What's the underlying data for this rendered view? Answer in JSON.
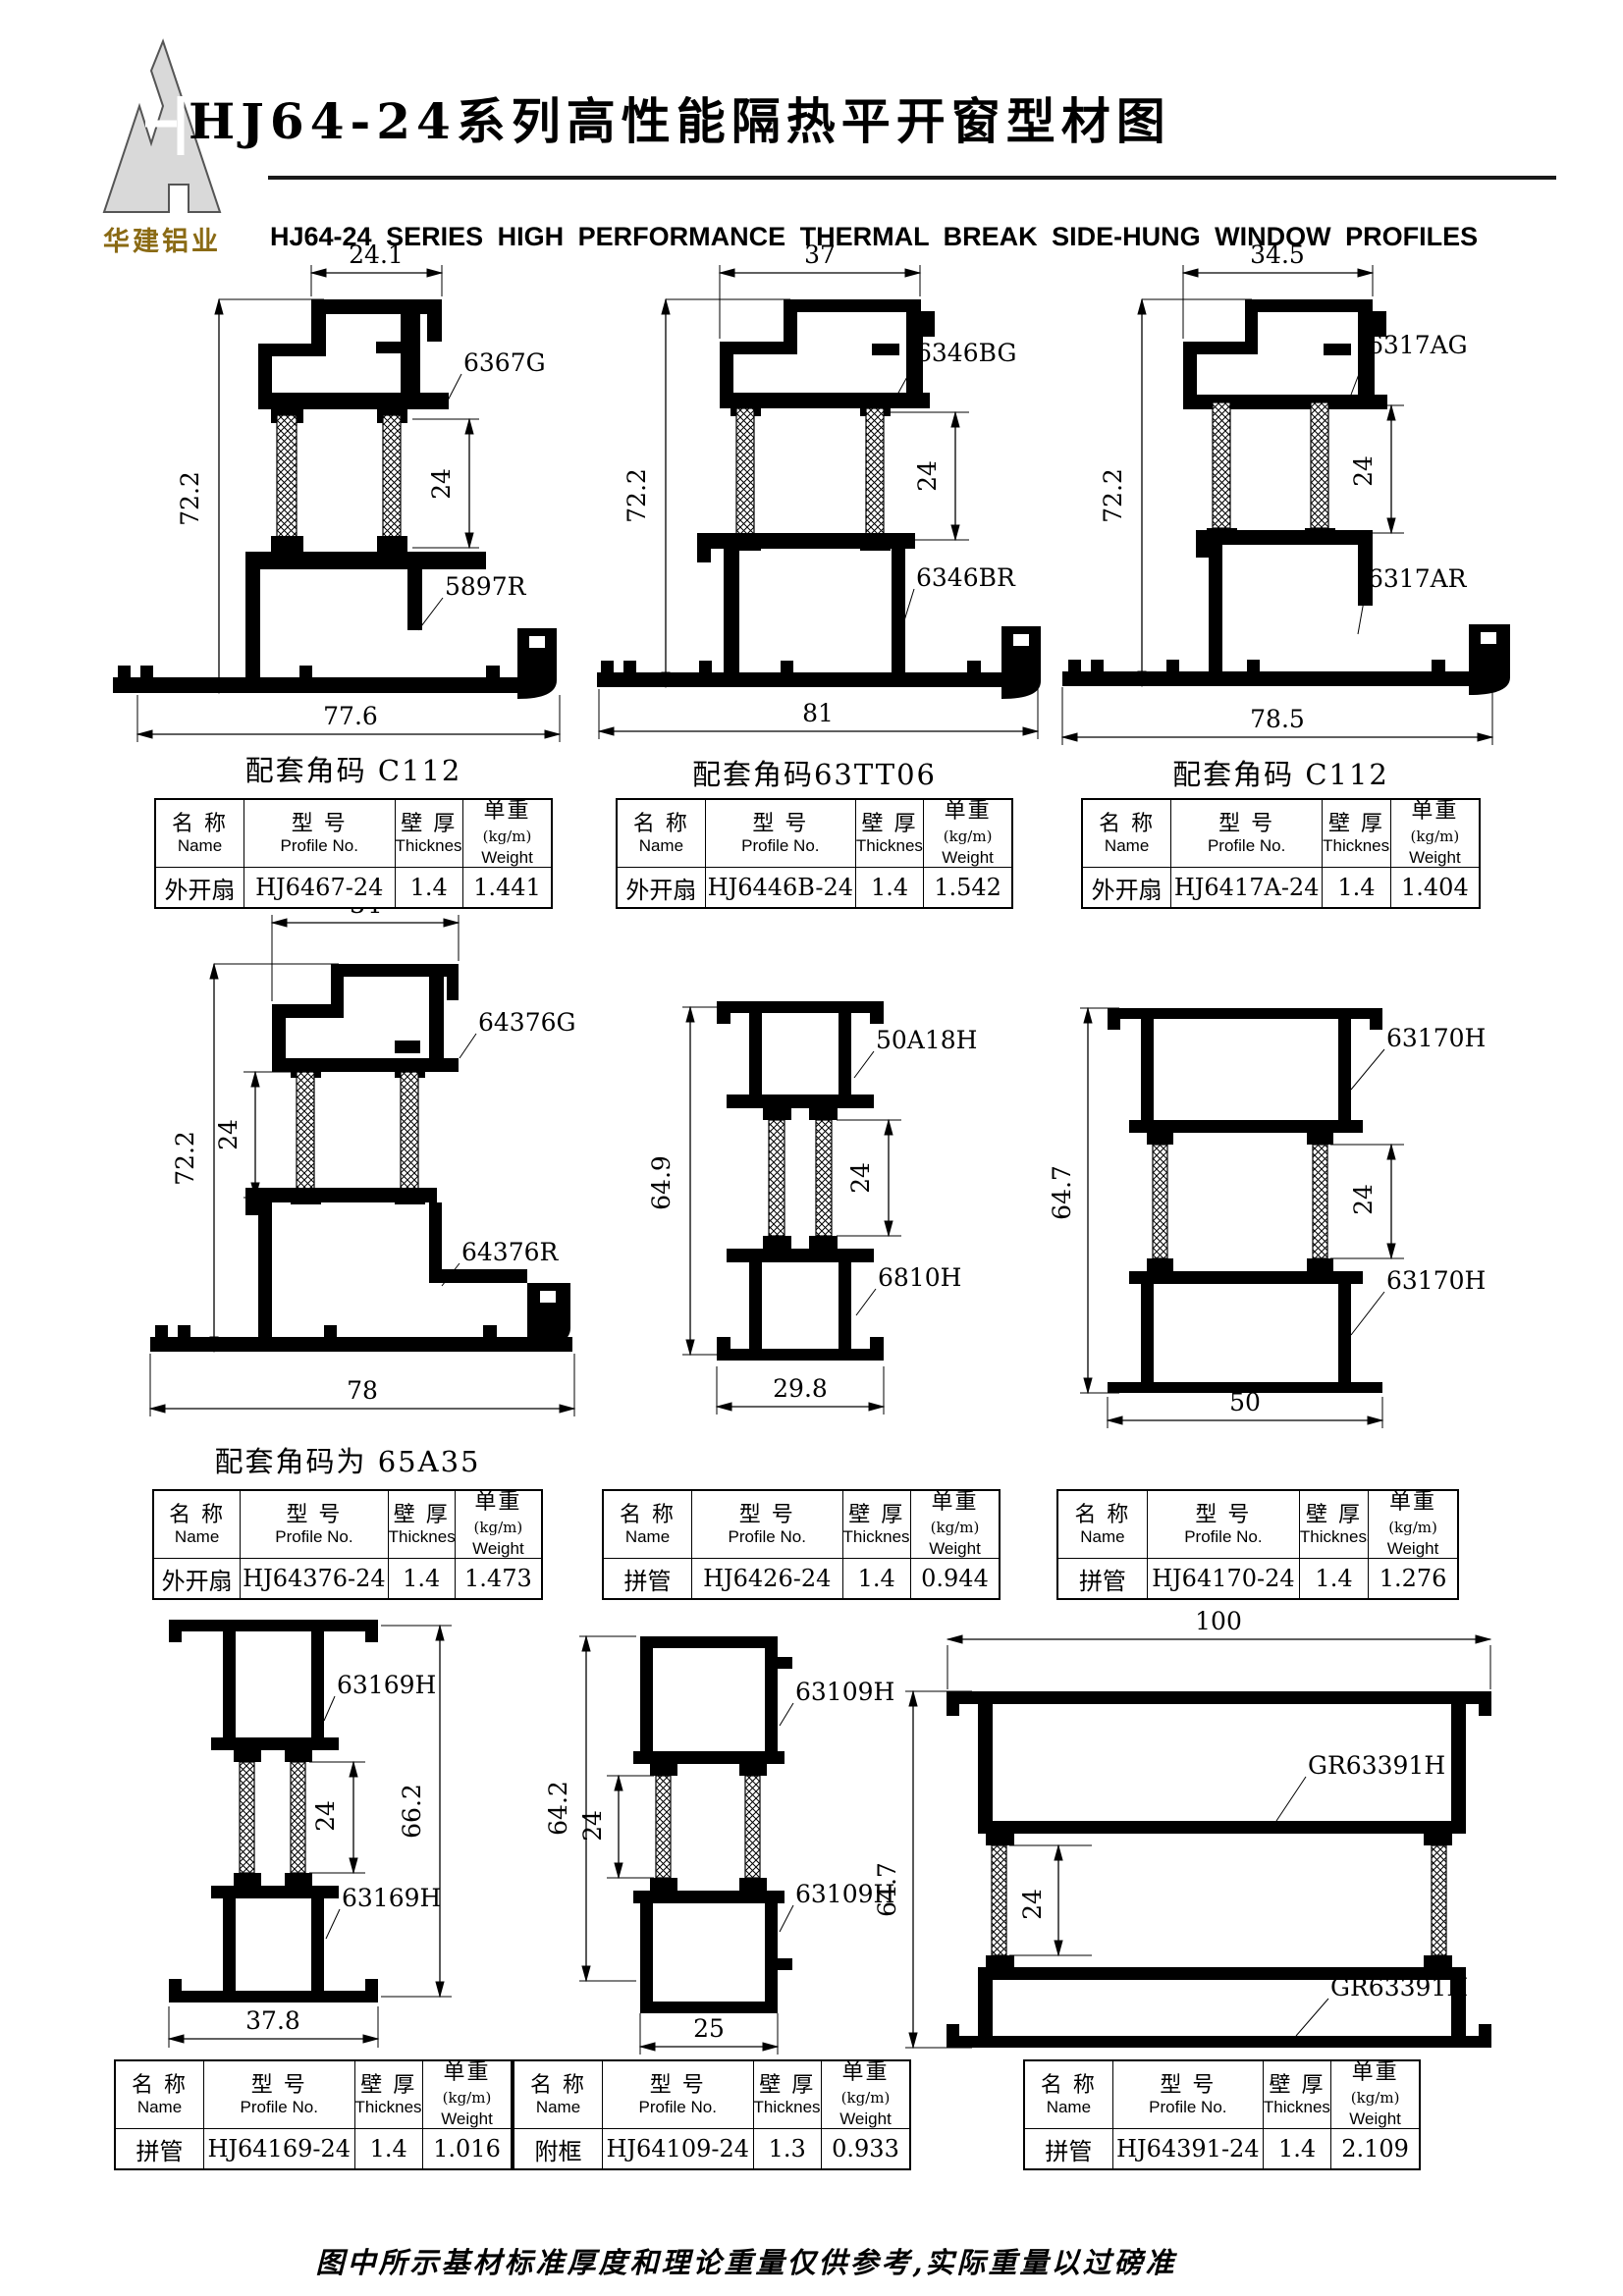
{
  "header": {
    "logo_text": "华建铝业",
    "title_zh": "HJ64-24系列高性能隔热平开窗型材图",
    "title_en": "HJ64-24 SERIES HIGH PERFORMANCE THERMAL BREAK SIDE-HUNG WINDOW PROFILES"
  },
  "table_headers": {
    "name_zh": "名 称",
    "name_en": "Name",
    "profile_zh": "型 号",
    "profile_en": "Profile No.",
    "thickness_zh": "壁 厚",
    "thickness_en": "Thickness",
    "weight_zh": "单重",
    "weight_unit": "(kg/m)",
    "weight_en": "Weight"
  },
  "drawings": [
    {
      "dims": {
        "top": "24.1",
        "height": "72.2",
        "glass": "24",
        "bottom": "77.6"
      },
      "label_top": "6367G",
      "label_bottom": "5897R",
      "caption": "配套角码 C112",
      "table": {
        "name": "外开扇",
        "profile": "HJ6467-24",
        "thickness": "1.4",
        "weight": "1.441"
      }
    },
    {
      "dims": {
        "top": "37",
        "height": "72.2",
        "glass": "24",
        "bottom": "81"
      },
      "label_top": "6346BG",
      "label_bottom": "6346BR",
      "caption": "配套角码63TT06",
      "table": {
        "name": "外开扇",
        "profile": "HJ6446B-24",
        "thickness": "1.4",
        "weight": "1.542"
      }
    },
    {
      "dims": {
        "top": "34.5",
        "height": "72.2",
        "glass": "24",
        "bottom": "78.5"
      },
      "label_top": "6317AG",
      "label_bottom": "6317AR",
      "caption": "配套角码 C112",
      "table": {
        "name": "外开扇",
        "profile": "HJ6417A-24",
        "thickness": "1.4",
        "weight": "1.404"
      }
    },
    {
      "dims": {
        "top": "34",
        "height": "72.2",
        "glass": "24",
        "bottom": "78"
      },
      "label_top": "64376G",
      "label_bottom": "64376R",
      "caption": "配套角码为 65A35",
      "table": {
        "name": "外开扇",
        "profile": "HJ64376-24",
        "thickness": "1.4",
        "weight": "1.473"
      }
    },
    {
      "dims": {
        "height": "64.9",
        "glass": "24",
        "bottom": "29.8"
      },
      "label_top": "50A18H",
      "label_bottom": "6810H",
      "caption": "",
      "table": {
        "name": "拼管",
        "profile": "HJ6426-24",
        "thickness": "1.4",
        "weight": "0.944"
      }
    },
    {
      "dims": {
        "height": "64.7",
        "glass": "24",
        "bottom": "50"
      },
      "label_top": "63170H",
      "label_bottom": "63170H",
      "caption": "",
      "table": {
        "name": "拼管",
        "profile": "HJ64170-24",
        "thickness": "1.4",
        "weight": "1.276"
      }
    },
    {
      "dims": {
        "height": "66.2",
        "glass": "24",
        "bottom": "37.8"
      },
      "label_top": "63169H",
      "label_bottom": "63169H",
      "caption": "",
      "table": {
        "name": "拼管",
        "profile": "HJ64169-24",
        "thickness": "1.4",
        "weight": "1.016"
      }
    },
    {
      "dims": {
        "height": "64.2",
        "glass": "24",
        "bottom": "25"
      },
      "label_top": "63109H",
      "label_bottom": "63109H",
      "caption": "",
      "table": {
        "name": "附框",
        "profile": "HJ64109-24",
        "thickness": "1.3",
        "weight": "0.933"
      }
    },
    {
      "dims": {
        "top": "100",
        "height": "64.7",
        "glass": "24"
      },
      "label_top": "GR63391H",
      "label_bottom": "GR63391H",
      "caption": "",
      "table": {
        "name": "拼管",
        "profile": "HJ64391-24",
        "thickness": "1.4",
        "weight": "2.109"
      }
    }
  ],
  "footer_note": "图中所示基材标准厚度和理论重量仅供参考,实际重量以过磅准"
}
